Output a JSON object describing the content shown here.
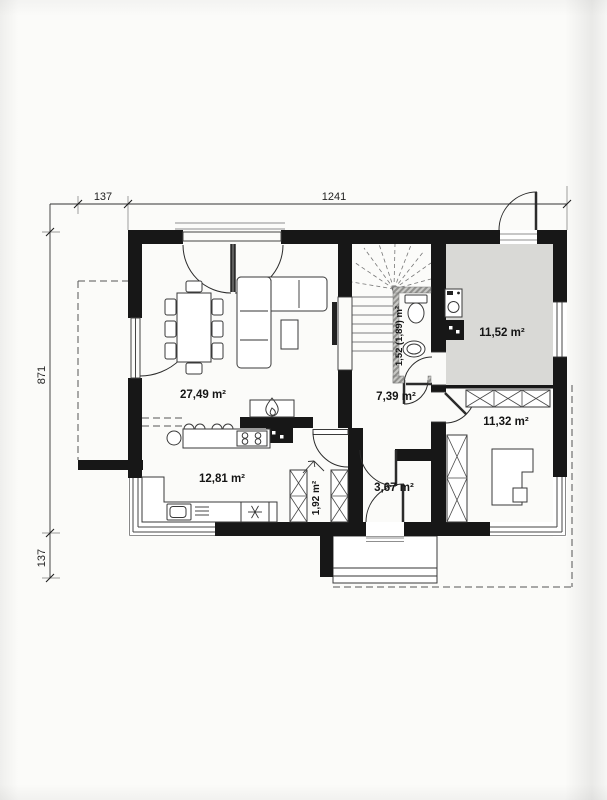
{
  "plan": {
    "dimensions": {
      "top_left_segment": "137",
      "top_main_segment": "1241",
      "left_main_segment": "871",
      "left_bottom_segment": "137"
    },
    "rooms": {
      "living": {
        "label": "27,49 m²"
      },
      "kitchen": {
        "label": "12,81 m²"
      },
      "hall": {
        "label": "7,39 m²"
      },
      "utility": {
        "label": "11,52 m²"
      },
      "bedroom": {
        "label": "11,32 m²"
      },
      "vestibule": {
        "label": "3,67 m²"
      },
      "pantry": {
        "label": "1,92 m²"
      },
      "bathroom": {
        "label": "1,52 (1,89) m²"
      }
    },
    "colors": {
      "wall": "#171717",
      "utility_floor": "#d9d9d6",
      "paper": "#fbfbf9",
      "line": "#333333"
    },
    "icons": [
      "fireplace-flame-icon",
      "snowflake-icon",
      "cooktop-burners-icon",
      "stairs-icon",
      "wardrobe-x-icon",
      "door-swing-icon",
      "entry-arrow-icon",
      "toilet-icon",
      "washbasin-icon",
      "washing-machine-icon"
    ]
  }
}
